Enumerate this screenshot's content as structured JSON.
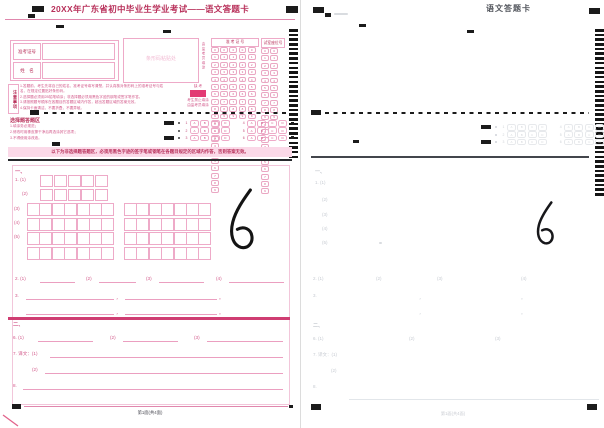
{
  "colors": {
    "red": "#b8305a",
    "ptext": "#d2598a",
    "pborder": "#eeaac8",
    "pinkline": "#e087ad",
    "solid": "#e23a73",
    "banner": "#fbd9e8",
    "divider": "#cf3d72",
    "ink": "#1b1b1b",
    "faint": "#c6cad1"
  },
  "left": {
    "title": "20XX年广东省初中毕业生学业考试——语文答题卡",
    "form": {
      "exam_no": "准考证号",
      "name": "姓　名"
    },
    "barcode_label": "条形码粘贴处",
    "notice": {
      "label": "注意事项",
      "lines": [
        "1.答题前，考生先将自己的姓名、准考证号填写清楚，并认真核对条形码上的准考证号与姓名，在规定位置贴好条形码。",
        "2.选择题必须用2B铅笔填涂；非选择题必须用黑色字迹的钢笔或签字笔作答。",
        "3.请按照题号顺序在各题目的答题区域内作答，超出答题区域的答案无效。",
        "4.保持卡面清洁，不要折叠，不要弄破。"
      ]
    },
    "absent": {
      "title": "缺 考",
      "note1": "考生禁止填涂",
      "note2": "由监考员填涂"
    },
    "digit_grid": {
      "side": "由监考员填涂",
      "header": "准 考 证 号"
    },
    "seat_grid": {
      "header": "试室座位号"
    },
    "mc": {
      "heading": "选择题答题区",
      "instructions": [
        "1.填涂务必规范；",
        "2.修改时用橡皮擦干净后再选涂其它选项；",
        "3.不得使用涂改液。"
      ]
    },
    "banner": "以下为非选择题答题区，必须用黑色字迹的签字笔或钢笔在各题目规定的区域内作答，否则答案无效。",
    "footer": "第1面(共4面)"
  },
  "right": {
    "title": "语文答题卡",
    "footer": "第1面(共4面)"
  },
  "shared": {
    "digits": [
      "0",
      "1",
      "2",
      "3",
      "4",
      "5",
      "6",
      "7",
      "8",
      "9"
    ],
    "options": [
      "A",
      "B",
      "C",
      "D"
    ],
    "mc_rows": [
      [
        "1",
        "4"
      ],
      [
        "2",
        "5"
      ],
      [
        "3",
        "6"
      ]
    ],
    "sec1": "一、",
    "q1": "1. (1)",
    "s2": "(2)",
    "s3": "(3)",
    "s4": "(4)",
    "s5": "(5)",
    "q2": "2. (1)",
    "q2s2": "(2)",
    "q2s3": "(3)",
    "q2s4": "(4)",
    "q3": "3.",
    "comma": "，",
    "period": "。",
    "sec2": "二、",
    "q6": "6. (1)",
    "q6s2": "(2)",
    "q6s3": "(3)",
    "q7": "7. 译文：(1)",
    "q7s2": "(2)",
    "q8": "8.",
    "handwriting": "6"
  }
}
